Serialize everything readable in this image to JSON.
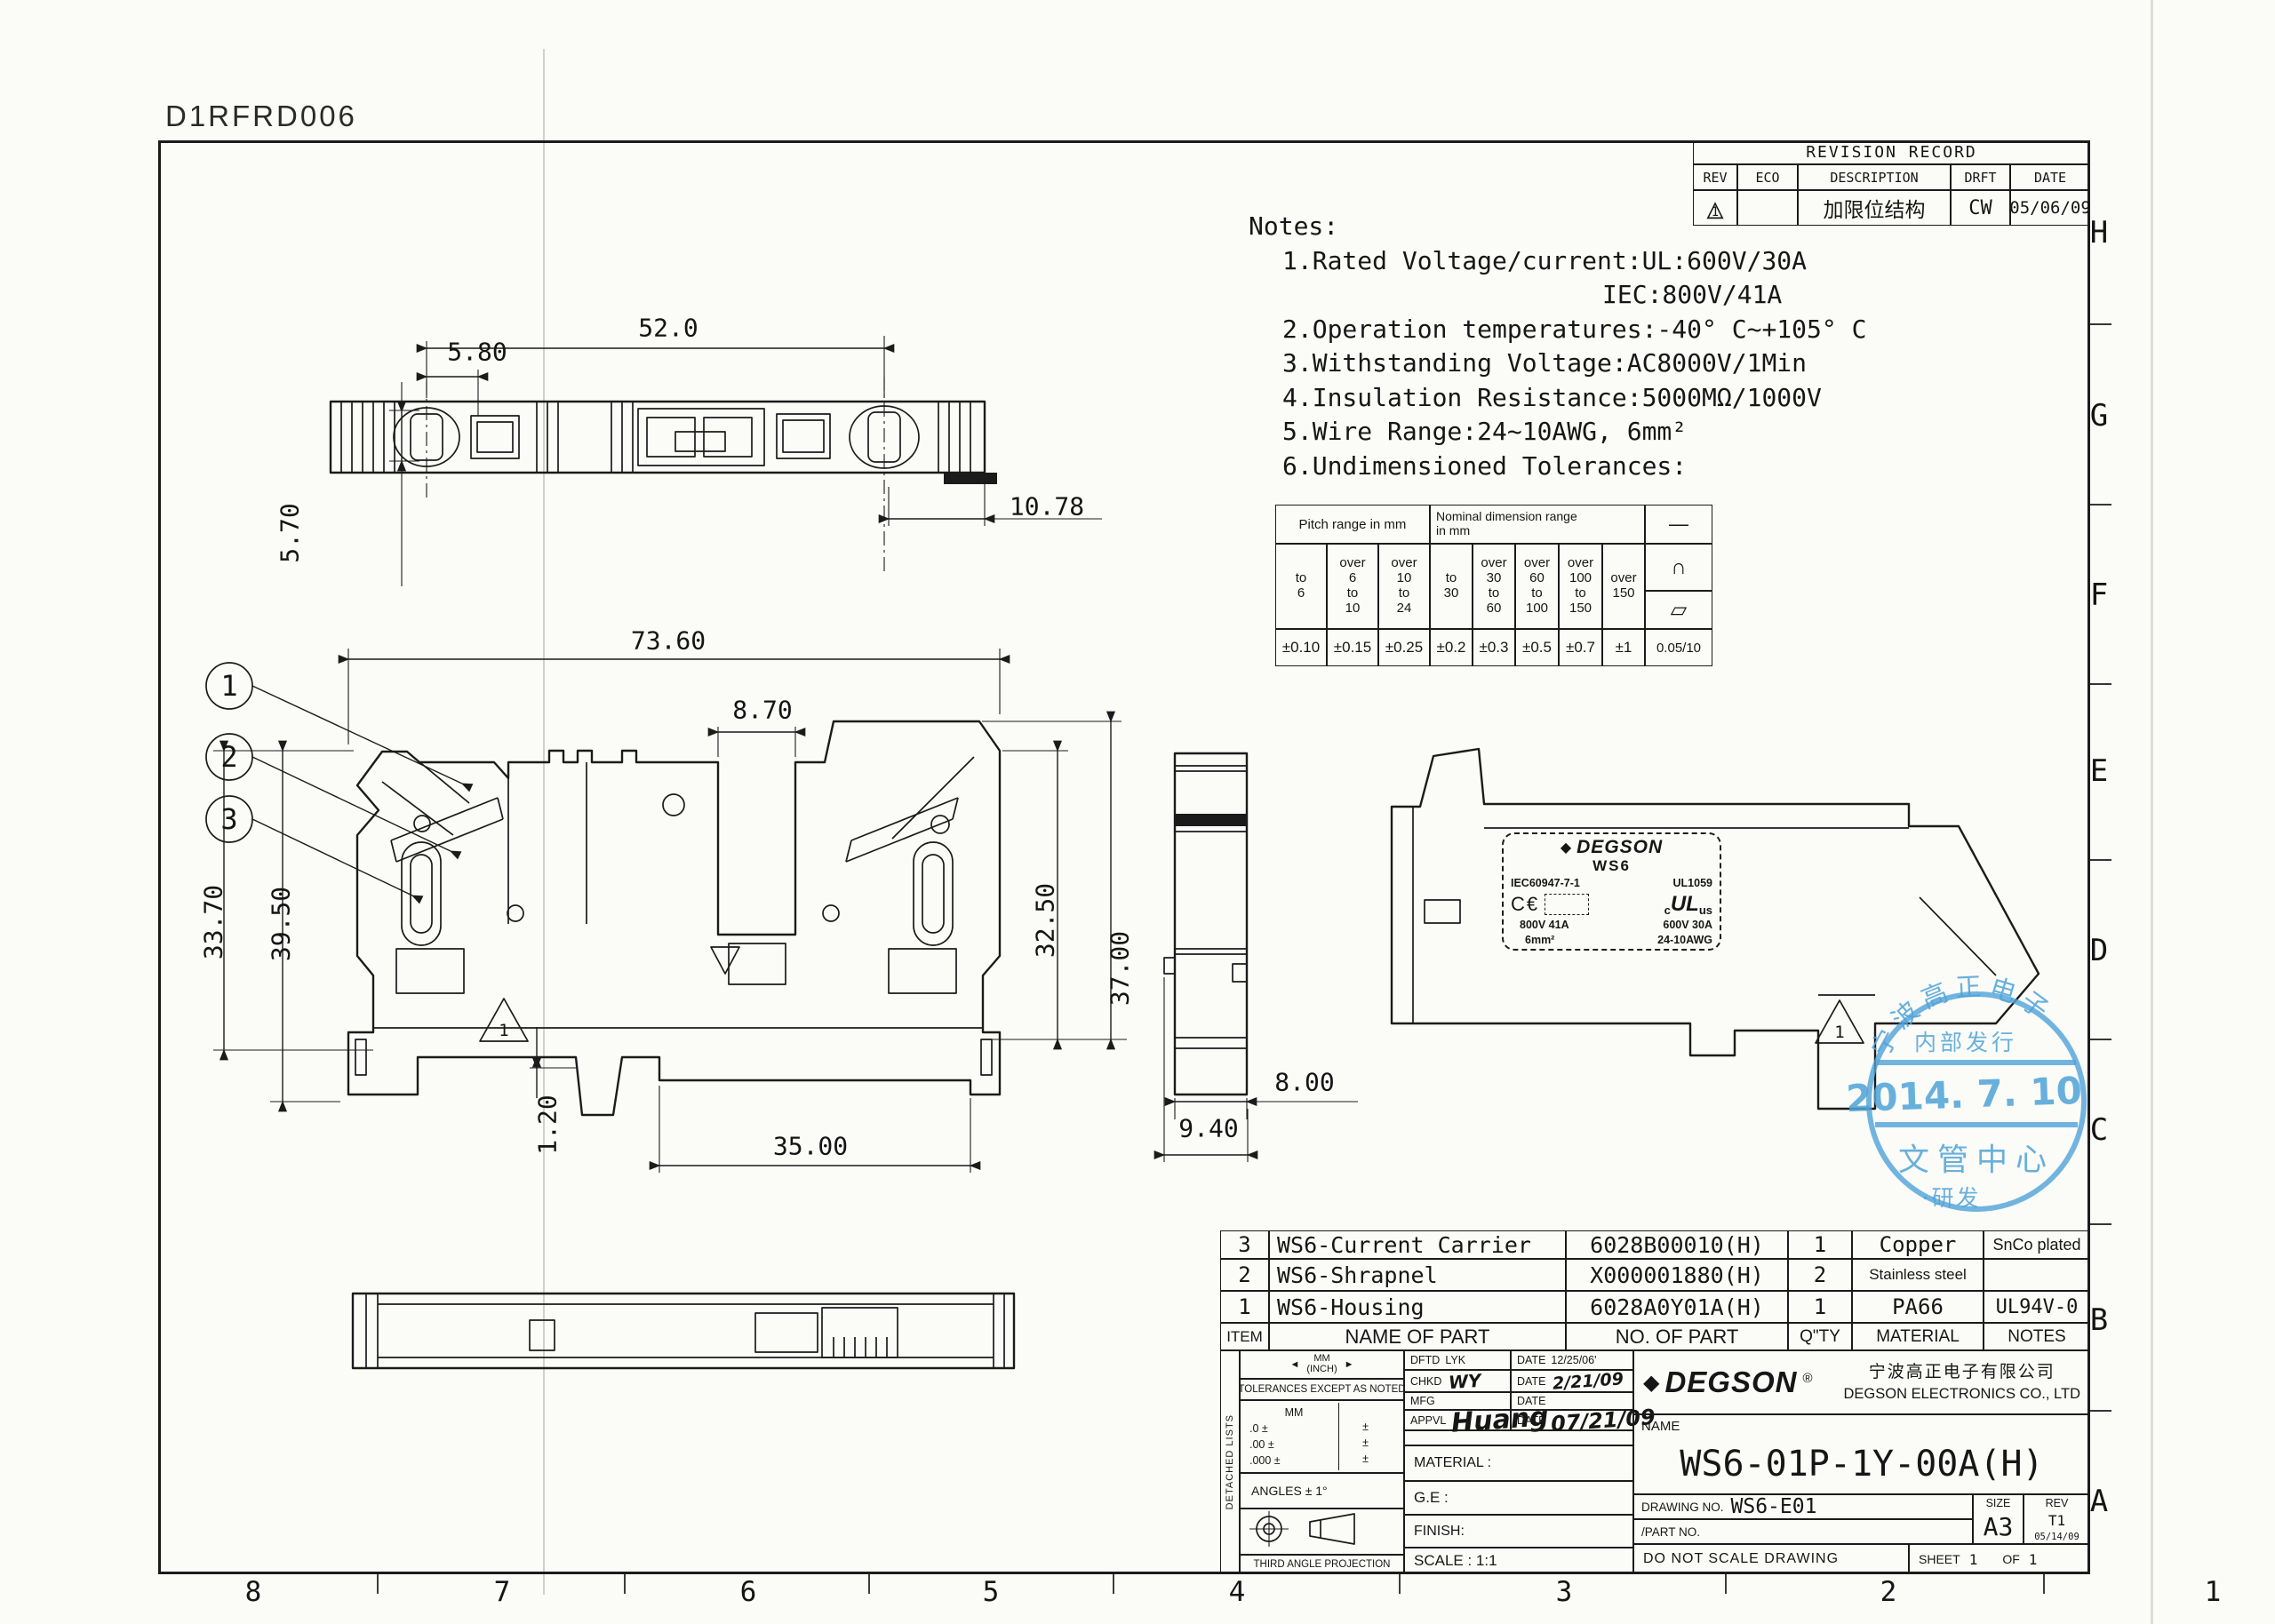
{
  "sheet": {
    "code": "D1RFRD006"
  },
  "grid_refs": {
    "bottom": [
      "8",
      "7",
      "6",
      "5",
      "4",
      "3",
      "2",
      "1"
    ],
    "right": [
      "H",
      "G",
      "F",
      "E",
      "D",
      "C",
      "B",
      "A"
    ]
  },
  "revision_table": {
    "title": "REVISION RECORD",
    "columns": [
      "REV",
      "ECO",
      "DESCRIPTION",
      "DRFT",
      "DATE"
    ],
    "row": {
      "rev_marker": "1",
      "eco": "",
      "description": "加限位结构",
      "drft": "CW",
      "date": "05/06/09"
    }
  },
  "notes": {
    "title": "Notes:",
    "line1": "1.Rated Voltage/current:UL:600V/30A",
    "line1b": "IEC:800V/41A",
    "line2": "2.Operation temperatures:-40° C~+105° C",
    "line3": "3.Withstanding Voltage:AC8000V/1Min",
    "line4": "4.Insulation Resistance:5000MΩ/1000V",
    "line5": "5.Wire Range:24~10AWG, 6mm²",
    "line6": "6.Undimensioned Tolerances:"
  },
  "tolerance_table": {
    "pitch_header": "Pitch range in mm",
    "nominal_header": "Nominal dimension range\nin mm",
    "pitch_cols": [
      "to\n6",
      "over\n6\nto\n10",
      "over\n10\nto\n24"
    ],
    "nominal_cols": [
      "to\n30",
      "over\n30\nto\n60",
      "over\n60\nto\n100",
      "over\n100\nto\n150",
      "over\n150"
    ],
    "pitch_values": [
      "±0.10",
      "±0.15",
      "±0.25"
    ],
    "nominal_values": [
      "±0.2",
      "±0.3",
      "±0.5",
      "±0.7",
      "±1"
    ],
    "symbols": [
      "—",
      "∩",
      "▱"
    ],
    "symbol_value": "0.05/10"
  },
  "dimensions": {
    "top_view": {
      "length": "52.0",
      "pitch": "5.80",
      "height": "5.70",
      "end_offset": "10.78"
    },
    "front_view": {
      "total_length": "73.60",
      "slot_width": "8.70",
      "height_left_inner": "33.70",
      "height_left_outer": "39.50",
      "height_right_inner": "32.50",
      "height_right_outer": "37.00",
      "step": "1.20",
      "rail_width": "35.00"
    },
    "side_view": {
      "body_width": "8.00",
      "total_width": "9.40"
    }
  },
  "balloons": [
    "1",
    "2",
    "3"
  ],
  "rev_marker": "1",
  "product_label": {
    "brand": "DEGSON",
    "series": "WS6",
    "iec_standard": "IEC60947-7-1",
    "ul_standard": "UL1059",
    "ce_mark": "C€",
    "cul_c": "c",
    "cul_ul": "UL",
    "cul_us": "us",
    "iec_rating": "800V 41A",
    "iec_wire": "6mm²",
    "ul_rating": "600V 30A",
    "ul_wire": "24-10AWG"
  },
  "stamp": {
    "arc_text": "宁波高正电子",
    "line2": "内部发行",
    "date": "2014. 7. 10",
    "line3": "文管中心",
    "line4": "·研发",
    "color": "#4fa3d8"
  },
  "parts_table": {
    "headers": [
      "ITEM",
      "NAME OF PART",
      "NO. OF PART",
      "Q\"TY",
      "MATERIAL",
      "NOTES"
    ],
    "rows": [
      {
        "item": "3",
        "name": "WS6-Current Carrier",
        "part_no": "6028B00010(H)",
        "qty": "1",
        "material": "Copper",
        "notes": "SnCo plated"
      },
      {
        "item": "2",
        "name": "WS6-Shrapnel",
        "part_no": "X000001880(H)",
        "qty": "2",
        "material": "Stainless steel",
        "notes": ""
      },
      {
        "item": "1",
        "name": "WS6-Housing",
        "part_no": "6028A0Y01A(H)",
        "qty": "1",
        "material": "PA66",
        "notes": "UL94V-0"
      }
    ]
  },
  "title_block": {
    "detached": "DETACHED LISTS",
    "units_mm": "MM",
    "units_inch": "(INCH)",
    "tol_note": "TOLERANCES EXCEPT AS NOTED",
    "tol_unit_header": "MM",
    "tol_rows": [
      {
        "label": ".0 ±",
        "value": "±"
      },
      {
        "label": ".00 ±",
        "value": "±"
      },
      {
        "label": ".000 ±",
        "value": "±"
      }
    ],
    "angles": "ANGLES ± 1°",
    "projection": "THIRD ANGLE PROJECTION",
    "staff": [
      {
        "label": "DFTD",
        "value": "LYK",
        "date_label": "DATE",
        "date": "12/25/06'"
      },
      {
        "label": "CHKD",
        "value": "WY",
        "date_label": "DATE",
        "date": "2/21/09"
      },
      {
        "label": "MFG",
        "value": "",
        "date_label": "DATE",
        "date": ""
      },
      {
        "label": "APPVL",
        "value": "Huang",
        "date_label": "DATE",
        "date": "07/21/09"
      }
    ],
    "material": "MATERIAL :",
    "ge": "G.E :",
    "finish": "FINISH:",
    "scale": "SCALE : 1:1",
    "brand": "DEGSON",
    "reg": "®",
    "company_cn": "宁波高正电子有限公司",
    "company_en": "DEGSON ELECTRONICS CO., LTD",
    "name_label": "NAME",
    "name_value": "WS6-01P-1Y-00A(H)",
    "drawing_no_label": "DRAWING NO.",
    "drawing_no": "WS6-E01",
    "part_no_label": "/PART NO.",
    "size_label": "SIZE",
    "size": "A3",
    "rev_label": "REV",
    "rev": "T1",
    "rev_date": "05/14/09",
    "do_not_scale": "DO NOT SCALE DRAWING",
    "sheet_label": "SHEET",
    "sheet_num": "1",
    "of_label": "OF",
    "of_num": "1"
  },
  "icons": {
    "triangle": "△",
    "diamond": "◆",
    "arrow_left": "◄",
    "arrow_right": "►"
  }
}
